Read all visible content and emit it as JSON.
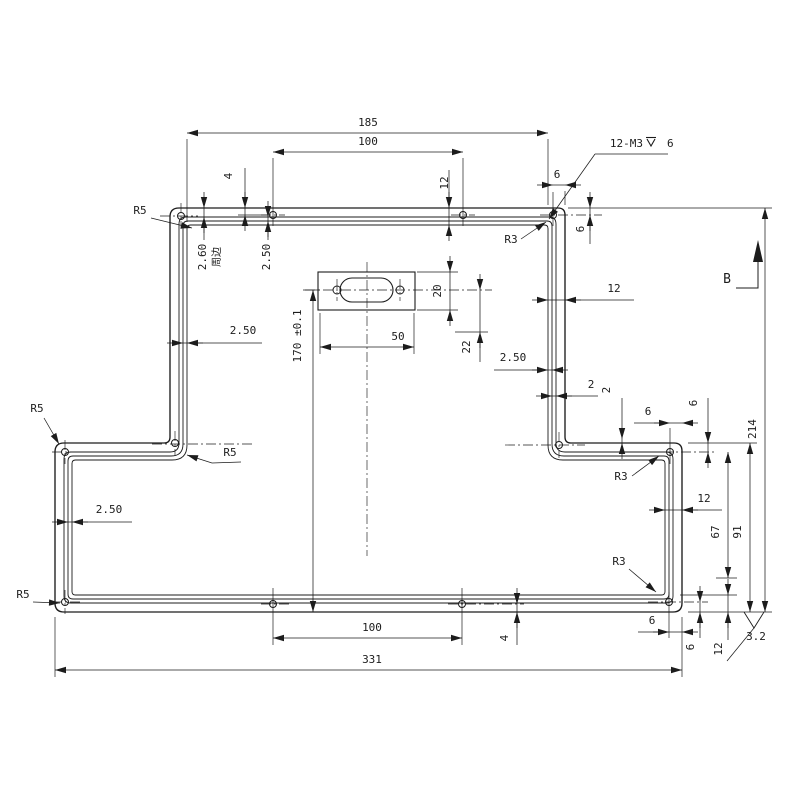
{
  "drawing": {
    "line_color": "#1c1c1c",
    "background": "#ffffff",
    "part": {
      "left": 55,
      "right": 682,
      "top": 208,
      "bottom": 612,
      "stem_left": 170,
      "stem_right": 565,
      "step_y": 443,
      "outer_radii": {
        "tl": 9,
        "tr": 7,
        "step": 6,
        "wing": 8,
        "corner": 9
      },
      "insets": [
        {
          "d": 9,
          "rc": 7,
          "rcc": 9
        },
        {
          "d": 13,
          "rc": 5,
          "rcc": 12
        },
        {
          "d": 17,
          "rc": 3.5,
          "rcc": 15
        }
      ]
    },
    "cutout": {
      "rect": {
        "x": 318,
        "y": 272,
        "w": 97,
        "h": 38
      },
      "stadium": {
        "x1": 340,
        "x2": 393,
        "y1": 278,
        "y2": 302,
        "r": 12
      },
      "screw_holes": [
        [
          337,
          290
        ],
        [
          400,
          290
        ]
      ],
      "screw_hole_r": 4
    },
    "holes": {
      "r": 3.5,
      "centers": [
        [
          181,
          216
        ],
        [
          273,
          215
        ],
        [
          463,
          215
        ],
        [
          553,
          215
        ],
        [
          175,
          443
        ],
        [
          559,
          445
        ],
        [
          65,
          452
        ],
        [
          670,
          452
        ],
        [
          65,
          602
        ],
        [
          669,
          602
        ],
        [
          273,
          604
        ],
        [
          462,
          604
        ]
      ]
    },
    "centerlines": [
      [
        305,
        290,
        492,
        290
      ],
      [
        367,
        262,
        367,
        556
      ],
      [
        337,
        279,
        337,
        301
      ],
      [
        400,
        279,
        400,
        301
      ],
      [
        160,
        216,
        198,
        216
      ],
      [
        181,
        203,
        181,
        229
      ],
      [
        261,
        215,
        285,
        215
      ],
      [
        451,
        215,
        475,
        215
      ],
      [
        540,
        215,
        602,
        215
      ],
      [
        152,
        444,
        252,
        444
      ],
      [
        175,
        431,
        175,
        456
      ],
      [
        505,
        445,
        585,
        445
      ],
      [
        559,
        432,
        559,
        458
      ],
      [
        52,
        452,
        80,
        452
      ],
      [
        65,
        440,
        65,
        464
      ],
      [
        645,
        452,
        716,
        452
      ],
      [
        52,
        602,
        80,
        602
      ],
      [
        65,
        590,
        65,
        614
      ],
      [
        648,
        602,
        708,
        602
      ],
      [
        261,
        604,
        292,
        604
      ],
      [
        448,
        604,
        524,
        604
      ]
    ],
    "dims_h": [
      {
        "y": 133,
        "a": 187,
        "b": 548,
        "t": "185",
        "lx": 368,
        "ly": 126,
        "style": "in",
        "ext": [
          [
            187,
            139,
            187,
            222
          ],
          [
            548,
            139,
            548,
            205
          ]
        ]
      },
      {
        "y": 152,
        "a": 273,
        "b": 463,
        "t": "100",
        "lx": 368,
        "ly": 145,
        "style": "in",
        "ext": [
          [
            273,
            158,
            273,
            226
          ],
          [
            463,
            158,
            463,
            226
          ]
        ]
      },
      {
        "y": 347,
        "a": 320,
        "b": 414,
        "t": "50",
        "lx": 398,
        "ly": 340,
        "style": "in",
        "ext": [
          [
            320,
            313,
            320,
            354
          ],
          [
            414,
            313,
            414,
            354
          ]
        ]
      },
      {
        "y": 638,
        "a": 273,
        "b": 462,
        "t": "100",
        "lx": 372,
        "ly": 631,
        "style": "in",
        "ext": [
          [
            273,
            588,
            273,
            645
          ],
          [
            462,
            588,
            462,
            645
          ]
        ]
      },
      {
        "y": 670,
        "a": 55,
        "b": 682,
        "t": "331",
        "lx": 372,
        "ly": 663,
        "style": "in",
        "ext": [
          [
            55,
            617,
            55,
            677
          ],
          [
            682,
            617,
            682,
            677
          ]
        ]
      },
      {
        "y": 300,
        "a": 548,
        "b": 565,
        "t": "12",
        "lx": 614,
        "ly": 292,
        "style": "out",
        "tail": [
          566,
          634
        ]
      },
      {
        "y": 510,
        "a": 665,
        "b": 682,
        "t": "12",
        "lx": 704,
        "ly": 502,
        "style": "out",
        "tail": [
          683,
          722
        ]
      },
      {
        "y": 185,
        "a": 553,
        "b": 565,
        "t": "6",
        "lx": 557,
        "ly": 178,
        "style": "out",
        "ext": [
          [
            553,
            192,
            553,
            226
          ],
          [
            565,
            191,
            565,
            205
          ]
        ]
      },
      {
        "y": 423,
        "a": 670,
        "b": 682,
        "t": "6",
        "lx": 648,
        "ly": 415,
        "style": "out",
        "tail": [
          634,
          669
        ],
        "ext": [
          [
            670,
            428,
            670,
            464
          ]
        ]
      },
      {
        "y": 632,
        "a": 669,
        "b": 682,
        "t": "6",
        "lx": 652,
        "ly": 624,
        "style": "out",
        "tail": [
          638,
          668
        ],
        "ext": [
          [
            669,
            592,
            669,
            638
          ]
        ]
      },
      {
        "y": 396,
        "a": 552,
        "b": 556,
        "t": "2",
        "lx": 591,
        "ly": 388,
        "style": "out",
        "tail": [
          557,
          598
        ]
      },
      {
        "y": 370,
        "a": 548,
        "b": 552,
        "t": "2.50",
        "lx": 513,
        "ly": 361,
        "style": "out",
        "tail": [
          494,
          547
        ]
      },
      {
        "y": 343,
        "a": 183,
        "b": 187,
        "t": "2.50",
        "lx": 243,
        "ly": 334,
        "style": "out",
        "tail": [
          188,
          262
        ]
      },
      {
        "y": 522,
        "a": 68,
        "b": 72,
        "t": "2.50",
        "lx": 109,
        "ly": 513,
        "style": "out",
        "tail": [
          73,
          132
        ]
      }
    ],
    "dims_v": [
      {
        "x": 204,
        "a": 208,
        "b": 217,
        "t": "2.60",
        "lx": 206,
        "ly": 257,
        "style": "out",
        "tailv": [
          218,
          240
        ]
      },
      {
        "x": 268,
        "a": 217,
        "b": 221,
        "t": "2.50",
        "lx": 270,
        "ly": 257,
        "style": "out",
        "tailv": [
          222,
          240
        ]
      },
      {
        "x": 245,
        "a": 208,
        "b": 215,
        "t": "4",
        "lx": 232,
        "ly": 176,
        "style": "out",
        "tailv": [
          168,
          207
        ],
        "ext": [
          [
            238,
            215,
            268,
            215
          ]
        ]
      },
      {
        "x": 449,
        "a": 208,
        "b": 225,
        "t": "12",
        "lx": 448,
        "ly": 183,
        "style": "out",
        "tailv": [
          170,
          207
        ]
      },
      {
        "x": 590,
        "a": 208,
        "b": 215,
        "t": "6",
        "lx": 584,
        "ly": 229,
        "style": "out",
        "tailv": [
          216,
          244
        ]
      },
      {
        "x": 450,
        "a": 272,
        "b": 310,
        "t": "20",
        "lx": 441,
        "ly": 291,
        "style": "out",
        "ext": [
          [
            417,
            272,
            458,
            272
          ],
          [
            417,
            310,
            458,
            310
          ]
        ]
      },
      {
        "x": 480,
        "a": 290,
        "b": 332,
        "t": "22",
        "lx": 470,
        "ly": 347,
        "style": "out",
        "tailv": [
          333,
          362
        ],
        "ext": [
          [
            455,
            332,
            488,
            332
          ]
        ]
      },
      {
        "x": 313,
        "a": 290,
        "b": 612,
        "t": "170 ±0.1",
        "lx": 301,
        "ly": 336,
        "style": "in",
        "ext": [
          [
            303,
            290,
            320,
            290
          ]
        ]
      },
      {
        "x": 765,
        "a": 208,
        "b": 612,
        "t": "214",
        "lx": 756,
        "ly": 429,
        "style": "in",
        "ext": [
          [
            568,
            208,
            772,
            208
          ],
          [
            688,
            612,
            772,
            612
          ]
        ]
      },
      {
        "x": 750,
        "a": 443,
        "b": 612,
        "t": "91",
        "lx": 741,
        "ly": 532,
        "style": "in",
        "ext": [
          [
            688,
            443,
            757,
            443
          ]
        ]
      },
      {
        "x": 728,
        "a": 452,
        "b": 578,
        "t": "67",
        "lx": 719,
        "ly": 532,
        "style": "in",
        "ext": [
          [
            716,
            578,
            737,
            578
          ]
        ]
      },
      {
        "x": 728,
        "a": 595,
        "b": 612,
        "t": "12",
        "lx": 722,
        "ly": 649,
        "style": "out",
        "tailv": [
          613,
          640
        ],
        "ext": [
          [
            680,
            595,
            737,
            595
          ]
        ]
      },
      {
        "x": 700,
        "a": 602,
        "b": 612,
        "t": "6",
        "lx": 694,
        "ly": 647,
        "style": "out",
        "tailv": [
          613,
          638
        ]
      },
      {
        "x": 708,
        "a": 443,
        "b": 452,
        "t": "6",
        "lx": 697,
        "ly": 403,
        "style": "out",
        "tailv": [
          398,
          427
        ]
      },
      {
        "x": 622,
        "a": 439,
        "b": 443,
        "t": "2",
        "lx": 610,
        "ly": 390,
        "style": "out",
        "tailv": [
          398,
          423
        ]
      },
      {
        "x": 517,
        "a": 604,
        "b": 612,
        "t": "4",
        "lx": 508,
        "ly": 638,
        "style": "out",
        "tailv": [
          613,
          645
        ]
      }
    ],
    "perimeter_note": {
      "text": "周边",
      "x": 220,
      "y": 257
    },
    "leaders": [
      {
        "t": "R5",
        "tx": 140,
        "ty": 214,
        "pts": [
          [
            151,
            218
          ],
          [
            192,
            228
          ]
        ]
      },
      {
        "t": "R5",
        "tx": 37,
        "ty": 412,
        "pts": [
          [
            44,
            418
          ],
          [
            59,
            444
          ]
        ]
      },
      {
        "t": "R5",
        "tx": 230,
        "ty": 456,
        "pts": [
          [
            241,
            462
          ],
          [
            212,
            463
          ],
          [
            187,
            455
          ]
        ]
      },
      {
        "t": "R5",
        "tx": 23,
        "ty": 598,
        "pts": [
          [
            33,
            602
          ],
          [
            60,
            603
          ]
        ]
      },
      {
        "t": "R3",
        "tx": 511,
        "ty": 243,
        "pts": [
          [
            521,
            239
          ],
          [
            546,
            222
          ]
        ]
      },
      {
        "t": "R3",
        "tx": 621,
        "ty": 480,
        "pts": [
          [
            632,
            476
          ],
          [
            659,
            456
          ]
        ]
      },
      {
        "t": "R3",
        "tx": 619,
        "ty": 565,
        "pts": [
          [
            629,
            569
          ],
          [
            656,
            592
          ]
        ]
      }
    ],
    "thread_note": {
      "prefix": "12-M3",
      "suffix": "6",
      "px": 643,
      "py": 147,
      "gx": 651,
      "sx": 661,
      "underline": [
        595,
        154,
        668,
        154
      ],
      "leader": [
        [
          595,
          154
        ],
        [
          549,
          219
        ]
      ]
    },
    "view_b": {
      "label": "B",
      "tx": 727,
      "ty": 283,
      "elbow": [
        [
          736,
          288
        ],
        [
          758,
          288
        ],
        [
          758,
          252
        ]
      ],
      "arrow_tip": [
        758,
        240
      ],
      "arrow_w": 5,
      "arrow_l": 22
    },
    "roughness": {
      "value": "3.2",
      "tx": 756,
      "ty": 640,
      "vee": [
        [
          744,
          612
        ],
        [
          754,
          628
        ],
        [
          764,
          612
        ]
      ],
      "leader": [
        [
          754,
          628
        ],
        [
          727,
          661
        ]
      ]
    }
  }
}
